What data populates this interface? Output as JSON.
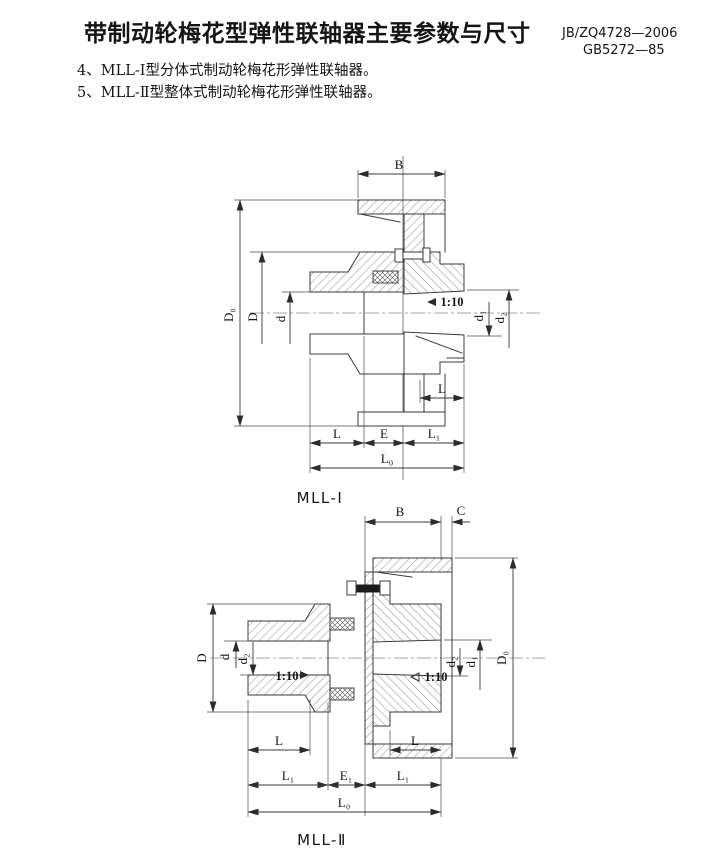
{
  "header": {
    "title": "带制动轮梅花型弹性联轴器主要参数与尺寸",
    "standard_1": "JB/ZQ4728—2006",
    "standard_2": "GB5272—85"
  },
  "notes": {
    "item_4": "4、MLL-Ⅰ型分体式制动轮梅花形弹性联轴器。",
    "item_5": "5、MLL-Ⅱ型整体式制动轮梅花形弹性联轴器。"
  },
  "fig1": {
    "caption": "MLL-Ⅰ",
    "taper": "1:10",
    "dim_B": "B",
    "dim_D0": "D₀",
    "dim_D": "D",
    "dim_d": "d",
    "dim_d1": "d₁",
    "dim_d2": "d₂",
    "dim_L_hub_right": "L",
    "dim_L": "L",
    "dim_E": "E",
    "dim_L1": "L₁",
    "dim_L0": "L₀"
  },
  "fig2": {
    "caption": "MLL-Ⅱ",
    "taper_left": "1:10",
    "taper_right": "1:10",
    "dim_B": "B",
    "dim_C": "C",
    "dim_D": "D",
    "dim_d": "d",
    "dim_d2_left": "d₂",
    "dim_d1": "d₁",
    "dim_d2_right": "d₂",
    "dim_D0": "D₀",
    "dim_L_left": "L",
    "dim_L_right": "L",
    "dim_L1_left": "L₁",
    "dim_E1": "E₁",
    "dim_L1_right": "L₁",
    "dim_L0": "L₀"
  },
  "colors": {
    "line": "#3a3a3a",
    "text": "#151515",
    "background": "#ffffff"
  }
}
